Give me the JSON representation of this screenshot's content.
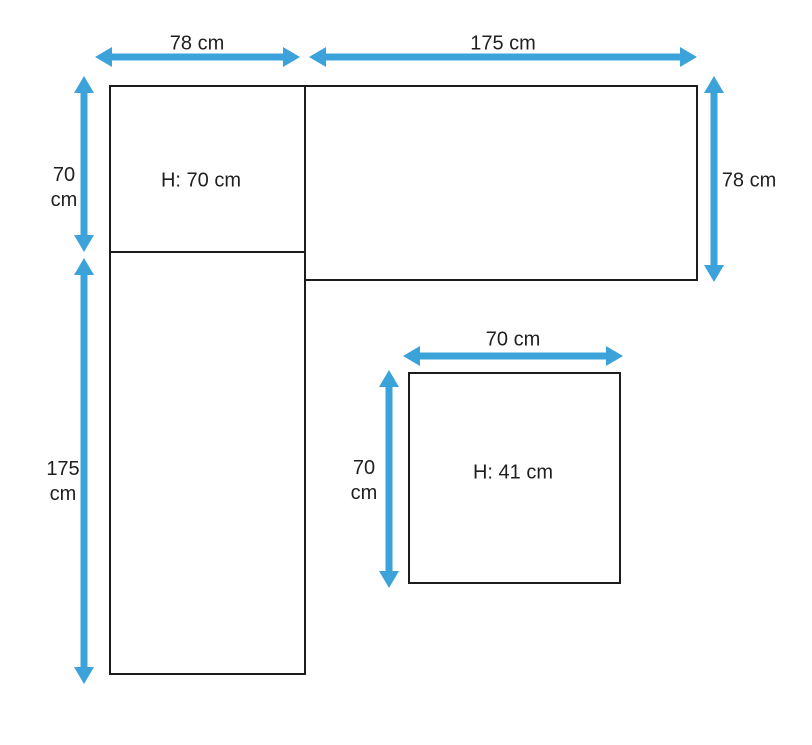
{
  "colors": {
    "arrow": "#3ba3da",
    "outline": "#1c1c1c",
    "text": "#1f1f1f",
    "background": "#ffffff"
  },
  "diagram": {
    "sofa": {
      "left_width": "78 cm",
      "right_width": "175 cm",
      "left_upper_height": {
        "value": "70",
        "unit": "cm"
      },
      "left_lower_height": {
        "value": "175",
        "unit": "cm"
      },
      "right_depth": "78 cm",
      "seat_height": "H: 70 cm"
    },
    "table": {
      "width": "70 cm",
      "depth": {
        "value": "70",
        "unit": "cm"
      },
      "height": "H: 41 cm"
    }
  }
}
